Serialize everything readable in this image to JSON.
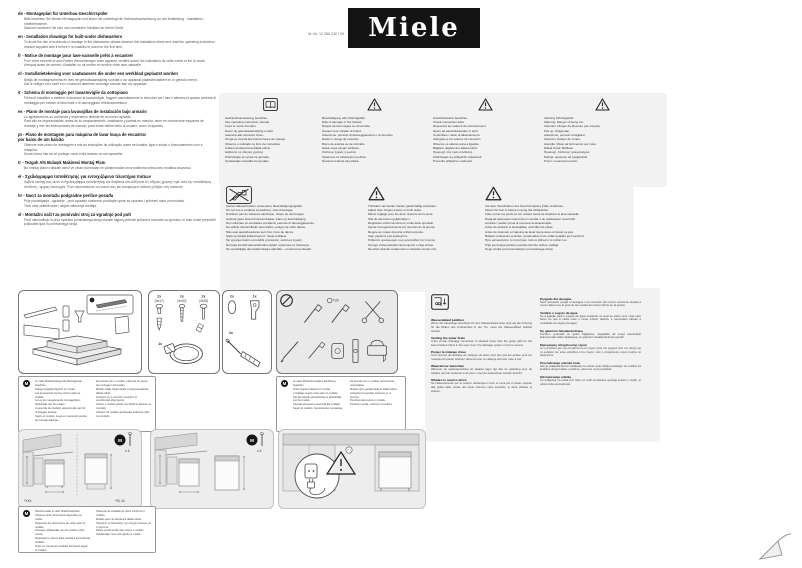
{
  "header": {
    "logo_text": "Miele",
    "material_number": "M.-Nr. 12 086 240 / 00"
  },
  "model_badge": "M",
  "languages": [
    {
      "code": "de",
      "title": "de - Montageplan für Unterbau-Geschirrspüler",
      "body": "Bitte beachten Sie diesen Montageplan und lesen Sie unbedingt die Gebrauchsanweisung vor der Aufstellung - Installation - Inbetriebnahme.\nDadurch schützen Sie sich und vermeiden Schäden an Ihrem Gerät."
    },
    {
      "code": "en",
      "title": "en - Installation drawings for built-under dishwashers",
      "body": "To avoid the risk of accidents or damage to the dishwasher please observe this installation sheet and read the operating instruction manual supplied with it before it is installed or used for the first time."
    },
    {
      "code": "fr",
      "title": "fr - Notice de montage pour lave-vaisselle prêts à encastrer",
      "body": "Pour votre sécurité et afin d'éviter d'endommager votre appareil, veuillez suivre les indications de cette notice et lire le mode d'emploi avant de monter, d'installer ou de mettre en service votre lave-vaisselle."
    },
    {
      "code": "nl",
      "title": "nl - Installatietekening voor vaatwassers die onder een werkblad geplaatst worden",
      "body": "Bekijk dit montageschema en lees de gebruiksaanwijzing voordat u uw apparaat plaatst/installeert en in gebruik neemt.\nDat is veiliger voor uzelf en u voorkomt daarmee onnodige schade aan uw apparaat."
    },
    {
      "code": "it",
      "title": "it - Schema di montaggio per lavastoviglie da sottopiano",
      "body": "Prima di installare e mettere in funzione la lavastoviglie, leggere assolutamente le istruzioni per l'uso e attenersi a questo schema di montaggio per evitare di farsi male o di danneggiare l'elettrodomestico."
    },
    {
      "code": "es",
      "title": "es - Plano de montaje para lavavajillas de instalación bajo armario",
      "body": "Le agradecemos su confianza y esperamos disfrute de su nuevo aparato.\nPara ello es imprescindible, antes de su emplazamiento, instalación y puesta en marcha, tener en cuenta este esquema de montaje y leer las instrucciones de manejo, para evitar daños tanto al usuario, como al aparato."
    },
    {
      "code": "pt",
      "title": "pt - Plano de montagem para máquina de lavar louça de encastrar\npor baixo de um balcão",
      "body": "Observe este plano de montagem e leia as instruções de utilização antes de instalar, ligar e iniciar o funcionamento com a máquina.\nDesta forma não só se protege como evita avarias no seu aparelho."
    },
    {
      "code": "tr",
      "title": "tr - Tezgah Altı Bulaşık Makinesi Montaj Planı",
      "body": "Bu montaj planını dikkate alınız ve cihazı kurmadan ve çalıştırmadan önce kullanma kılavuzunu mutlaka okuyunuz."
    },
    {
      "code": "el",
      "title": "el - Σχεδιάγραμμα τοποθέτησης για εντοιχιζόμενα πλυντήρια πιάτων",
      "body": "Λάβετε υπόψη σας αυτό το σχεδιάγραμμα τοποθέτησης και διαβάστε οπωσδήποτε τις οδηγίες χρήσης πριν από την τοποθέτηση - σύνδεση - αρχική λειτουργία. Έτσι προστατεύετε τον εαυτό σας και αποφεύγετε πιθανές βλάβες στη συσκευή."
    },
    {
      "code": "hr",
      "title": "hr - Nacrt za montažu podgradne perilice posuđa",
      "body": "Prije postavljanja - ugradnje - prve uporabe obavezno pročitajte upute za uporabu i priloženi nacrt za montažu.\nTime ćete zaštititi sebe i izbjeći oštećenja uređaja."
    },
    {
      "code": "sl",
      "title": "sl - Montažni načrt za pomivalni stroj za vgradnjo pod pult",
      "body": "Pred namestitvijo in prvo uporabo pomivalnega stroja morate najprej prebrati priložena navodila za uporabo, le tako boste preprečili poškodbe ljudi in pomivalnega stroja."
    }
  ],
  "warnings_row1": [
    {
      "icon": "open-book-icon",
      "lines": "Gebrauchsanweisung beachten.\nSee operating instruction manual.\nLisez le mode d'emploi.\nNeem de gebruiksaanwijzing in acht.\nAttenersi alle istruzioni d'uso.\nTenga en cuenta las instrucciones de manejo.\nObserve o indicado no livro de instruções.\nKullanma kılavuzuna dikkat ediniz.\nΔιαβάστε τις οδηγίες χρήσης.\nPridržavajte se uputa za uporabu.\nUpoštevajte navodila za uporabo."
    },
    {
      "icon": "warning-triangle-icon",
      "lines": "Beschädigung oder Brandgefahr.\nRisk of damage or fire hazard.\nRisque de dommages ou d'incendie.\nGevaar voor schade of brand.\nAttenzione: pericolo di danneggiamento o di incendio.\nDaños o riesgo de incendio.\nRisco de avarias ou de incêndio.\nHasar veya yangın tehlikesi.\nΚίνδυνος ζημιάς ή φωτιάς.\nOpasnost od oštećenja ili požara.\nNevarnost škode ali požara."
    },
    {
      "icon": "warning-triangle-icon",
      "lines": "Anschlusswerte beachten.\nCheck connection data.\nRespectez les valeurs de raccordement.\nNeem de aansluitwaarden in acht.\nControllare i valori di allacciamento.\nAténgase a los valores de conexión.\nObserve os valores para a ligação.\nBağlantı değerlerine dikkat ediniz.\nΠροσοχή στις τιμές σύνδεσης.\nPridržavajte se priključnih vrijednosti.\nPreverite priključne vrednosti."
    },
    {
      "icon": "warning-triangle-icon",
      "lines": "Achtung Schnittgefahr.\nWarning: Danger of being cut.\nAttention. Risque de blessure par coupure.\nPas op. Snijgevaar.\nAttenzione, pericolo di tagliarsi.\nAtención. Peligro de cortes.\nAtenção. Risco de ferimentos por corte.\nDikkat Kesik Tehlikesi.\nΠροσοχή. Κίνδυνος τραυματισμού.\nPažnja: opasnost od posjekotina.\nPozor: nevarnost ureznin."
    }
  ],
  "warnings_row2": [
    {
      "icon": "no-cordless-screwdriver-icon",
      "lines": "Keinen Akkuschrauber verwenden, Beschädigungsgefahr.\nDo not use a cordless screwdriver, risk of damage.\nN'utilisez pas de visseuse électrique, risque de dommages.\nGebruik geen accuschroevendraaier. Kans op beschadiging.\nNon utilizzare un avvitatore a batteria, pericolo di danneggiamento.\nNo utilizar destornillador automático, peligro de sufrir daños.\nNão usar aparafusadoras sem fios, risco de danos.\nŞarjlı tornavida kullanmayınız, hasar tehlikesi.\nΜη χρησιμοποιείτε κατσαβίδι μπαταρίας, κίνδυνος ζημιάς.\nNemojte koristiti akumulatorski odvijač, opasnost od oštećenja.\nNe uporabljajte akumulatorskega vijačnika – nevarnost poškodb."
    },
    {
      "icon": "warning-triangle-icon",
      "lines": "Türfedern auf beiden Seiten gleichmäßig einstellen.\nAdjust door hinges evenly on both sides.\nMême réglage pour les deux ressorts de la porte.\nStel de deurveren gelijkmatig in.\nRegistrare uniformemente le molle dello sportello.\nAjuste homogéneamente los resortes de la puerta.\nRegule as molas da porta uniformemente.\nKapı yaylarını eşit ayarlayınız.\nΡυθμίστε ομοιόμορφα τους μεντεσέδες της πόρτας.\nOpruge vrata podesite ravnomjerno s obje strane.\nNa obeh straneh enakomerno nastavite vzmeti vrat."
    },
    {
      "icon": "warning-triangle-icon",
      "lines": "Vor dem Verschieben des Geschirrspülers Füße eindrehen.\nScrew the feet in before moving the dishwasher.\nFaire entrer les pieds en les vissant avant de déplacer le lave-vaisselle.\nDraai de stelvoeten naar binnen voordat u de vaatwasser verschuift.\nAvvitare i piedini prima di muovere la lavastoviglie.\nAntes de deslizar el lavavajillas, atornillar las patas.\nAntes de deslocar a máquina de lavar louça deve enroscar os pés.\nBulaşık makinesini yerinden oynatmadan önce vidalı ayakları içeri çeviriniz.\nΠριν μετακινήσετε το πλυντήριο πιάτων βιδώστε τα πόδια του.\nPrije pomicanja perilice posuđa zavrnite nožice uređaja.\nNoge privijte pred premikanjem pomivalnega stroja."
    }
  ],
  "supplied_parts": {
    "screws": [
      {
        "qty": "2x",
        "size": "(4x17)"
      },
      {
        "qty": "1x",
        "size": "(4x20)"
      },
      {
        "qty": "2x",
        "size": "(4x35)"
      }
    ],
    "clamp_qty": "1x",
    "extra": [
      {
        "qty": "2x"
      },
      {
        "qty": "1x"
      },
      {
        "qty": "2x"
      }
    ]
  },
  "tools": {
    "torx_label": "T20"
  },
  "model_note_unpacking": {
    "left": "Je nach Modell beiliegende Montageteile beachten.\nFittings supplied depend on model.\nLes accessoires fournis varient selon le modèle.\nLet op de meegeleverde montagedelen, afhankelijk van het model.\nA seconda del modello attenersi alle parti di montaggio accluse.\nSegún el modelo, tenga en cuenta las piezas de montaje adjuntas.",
    "right": "De acordo com o modelo, observar as peças de montagem fornecidas.\nModele bağlı olarak ekteki montaj parçalarına dikkat ediniz.\nΑνάλογα με το μοντέλο προσέξτε τα συνοδευτικά εξαρτήματα.\nOvisno o modelu pazite na priložene dijelove za montažu.\nOdvisno od modela upoštevajte priložene dele za montažo."
  },
  "model_note_tools": {
    "left": "Je nach Modell benötigtes Werkzeug beachten.\nTools required depend on model.\nL'outillage requis varie selon le modèle.\nHet benodigde gereedschap is afhankelijk van het model.\nUtensili necessari a seconda del modello.\nSegún el modelo, herramientas necesarias.",
    "right": "De acordo com o modelo, ferramentas necessárias.\nModele göre gerekli aletlere dikkat ediniz.\nΑπαραίτητα εργαλεία ανάλογα με το μοντέλο.\nPotreban alat ovisno o modelu.\nPotrebno orodje, odvisno od modela."
  },
  "model_note_dimensions": {
    "left": "Nischenmaße je nach Modell beachten.\nObserve niche dimensions depending on model.\nRespectez les dimensions de niche selon le modèle.\nNismaten afhankelijk van het model in acht nemen.\nRispettare le misure della nicchia a seconda del modello.\nTener en cuenta las medidas del hueco según el modelo.",
    "right": "Observar as medidas do nicho conforme o modelo.\nModele göre niş ölçülerine dikkat ediniz.\nΠροσέξτε τις διαστάσεις της εσοχής ανάλογα με το μοντέλο.\nPazite na dimenzije niše ovisno o modelu.\nUpoštevajte mere niše glede na model."
  },
  "drain": {
    "left": [
      {
        "heading": "Wasserablauf belüften",
        "body": "Wenn der bauseitige Anschluss für den Wasserablauf tiefer liegt als die Führung für die Rollen des Unterkorbes in der Tür, muss der Wasserablauf belüftet werden."
      },
      {
        "heading": "Venting the water drain",
        "body": "If the on-site drainage connection is situated lower than the guide path for the lower basket rollers in the open door, the drainage system must be vented."
      },
      {
        "heading": "Purger la vidange d'eau",
        "body": "Si le raccord domestique de vidange est placé plus bas que les guides pour les roulettes du panier inférieur dans la porte, la vidange doit être mise à l'air."
      },
      {
        "heading": "Waterafvoer beluchten",
        "body": "Wanneer de wateraansluiting ter plaatse lager ligt dan de geleiding voor de wieltjes van het onderrek in de deur, moet de waterafvoer worden belucht."
      },
      {
        "heading": "Sfiatare lo scarico idrico",
        "body": "Se l'allacciamento per lo scarico dell'acqua in loco si trova più in basso rispetto alla guida delle rotelle del cesto inferiore nello sportello, si deve sfiatare lo scarico."
      }
    ],
    "right": [
      {
        "heading": "Purgado del desagüe",
        "body": "Será necesario purgar el desagüe si la conexión del mismo estuviera situada a menor altura que la guía de las ruedas del cesto inferior en la puerta."
      },
      {
        "heading": "Ventilar o esgoto da água",
        "body": "Se a ligação para o esgoto da água existente no local se situar num nível mais baixo do que a calha onde o cesto inferior desliza, é necessário efetuar a ventilação do esgoto da água."
      },
      {
        "heading": "Su giderinin havalandırılması",
        "body": "Kurulum yerindeki su gideri bağlantısı, kapaktaki alt sepet tekerlekleri kılavuzundan daha alçaktaysa, su giderinin havalandırılması gerekir."
      },
      {
        "heading": "Εξαερισμός αποχέτευσης νερού",
        "body": "Αν η σύνδεση για την αποχέτευση του νερού είναι πιο χαμηλά από τον οδηγό για τα ροδάκια του κάτω καλαθιού στην πόρτα, τότε η αποχέτευση νερού πρέπει να εξαερίζεται."
      },
      {
        "heading": "Prozračivanje odvoda vode",
        "body": "Ako je priključak kućne instalacije za odvod vode dublje postavljen od vodilice za kotačiće donje košare u vratima, odvod se mora ventilirati."
      },
      {
        "heading": "Odzračevanje odtoka",
        "body": "Če priključek za odtok leži nižje od vodil za kolesca spodnje košare v vratih, je odtok treba prezračevati."
      }
    ]
  },
  "diagrams": {
    "d1_label_left": "*XXL",
    "d1_label_right": "*SL XL",
    "d1_screws": "x 4",
    "d2_screws": "x 4"
  }
}
